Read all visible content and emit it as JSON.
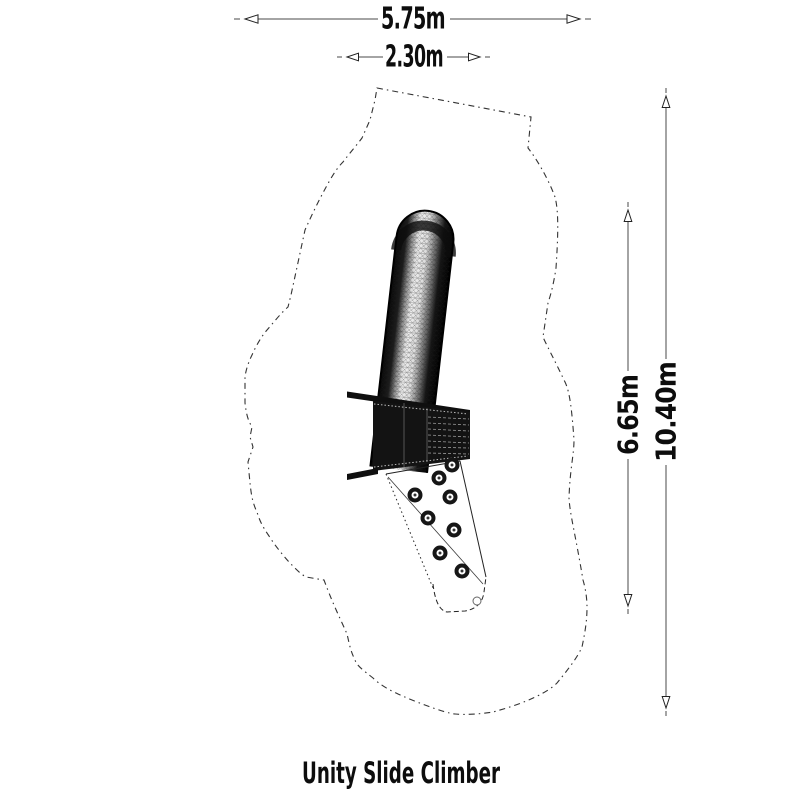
{
  "diagram": {
    "title": "Unity Slide Climber",
    "dimensions": {
      "safety_area_width": "5.75m",
      "equipment_width": "2.30m",
      "equipment_height": "6.65m",
      "safety_area_length": "10.40m"
    },
    "colors": {
      "ink": "#0d0d0d",
      "dimension_line": "#4a4a4a",
      "background": "#ffffff"
    }
  }
}
